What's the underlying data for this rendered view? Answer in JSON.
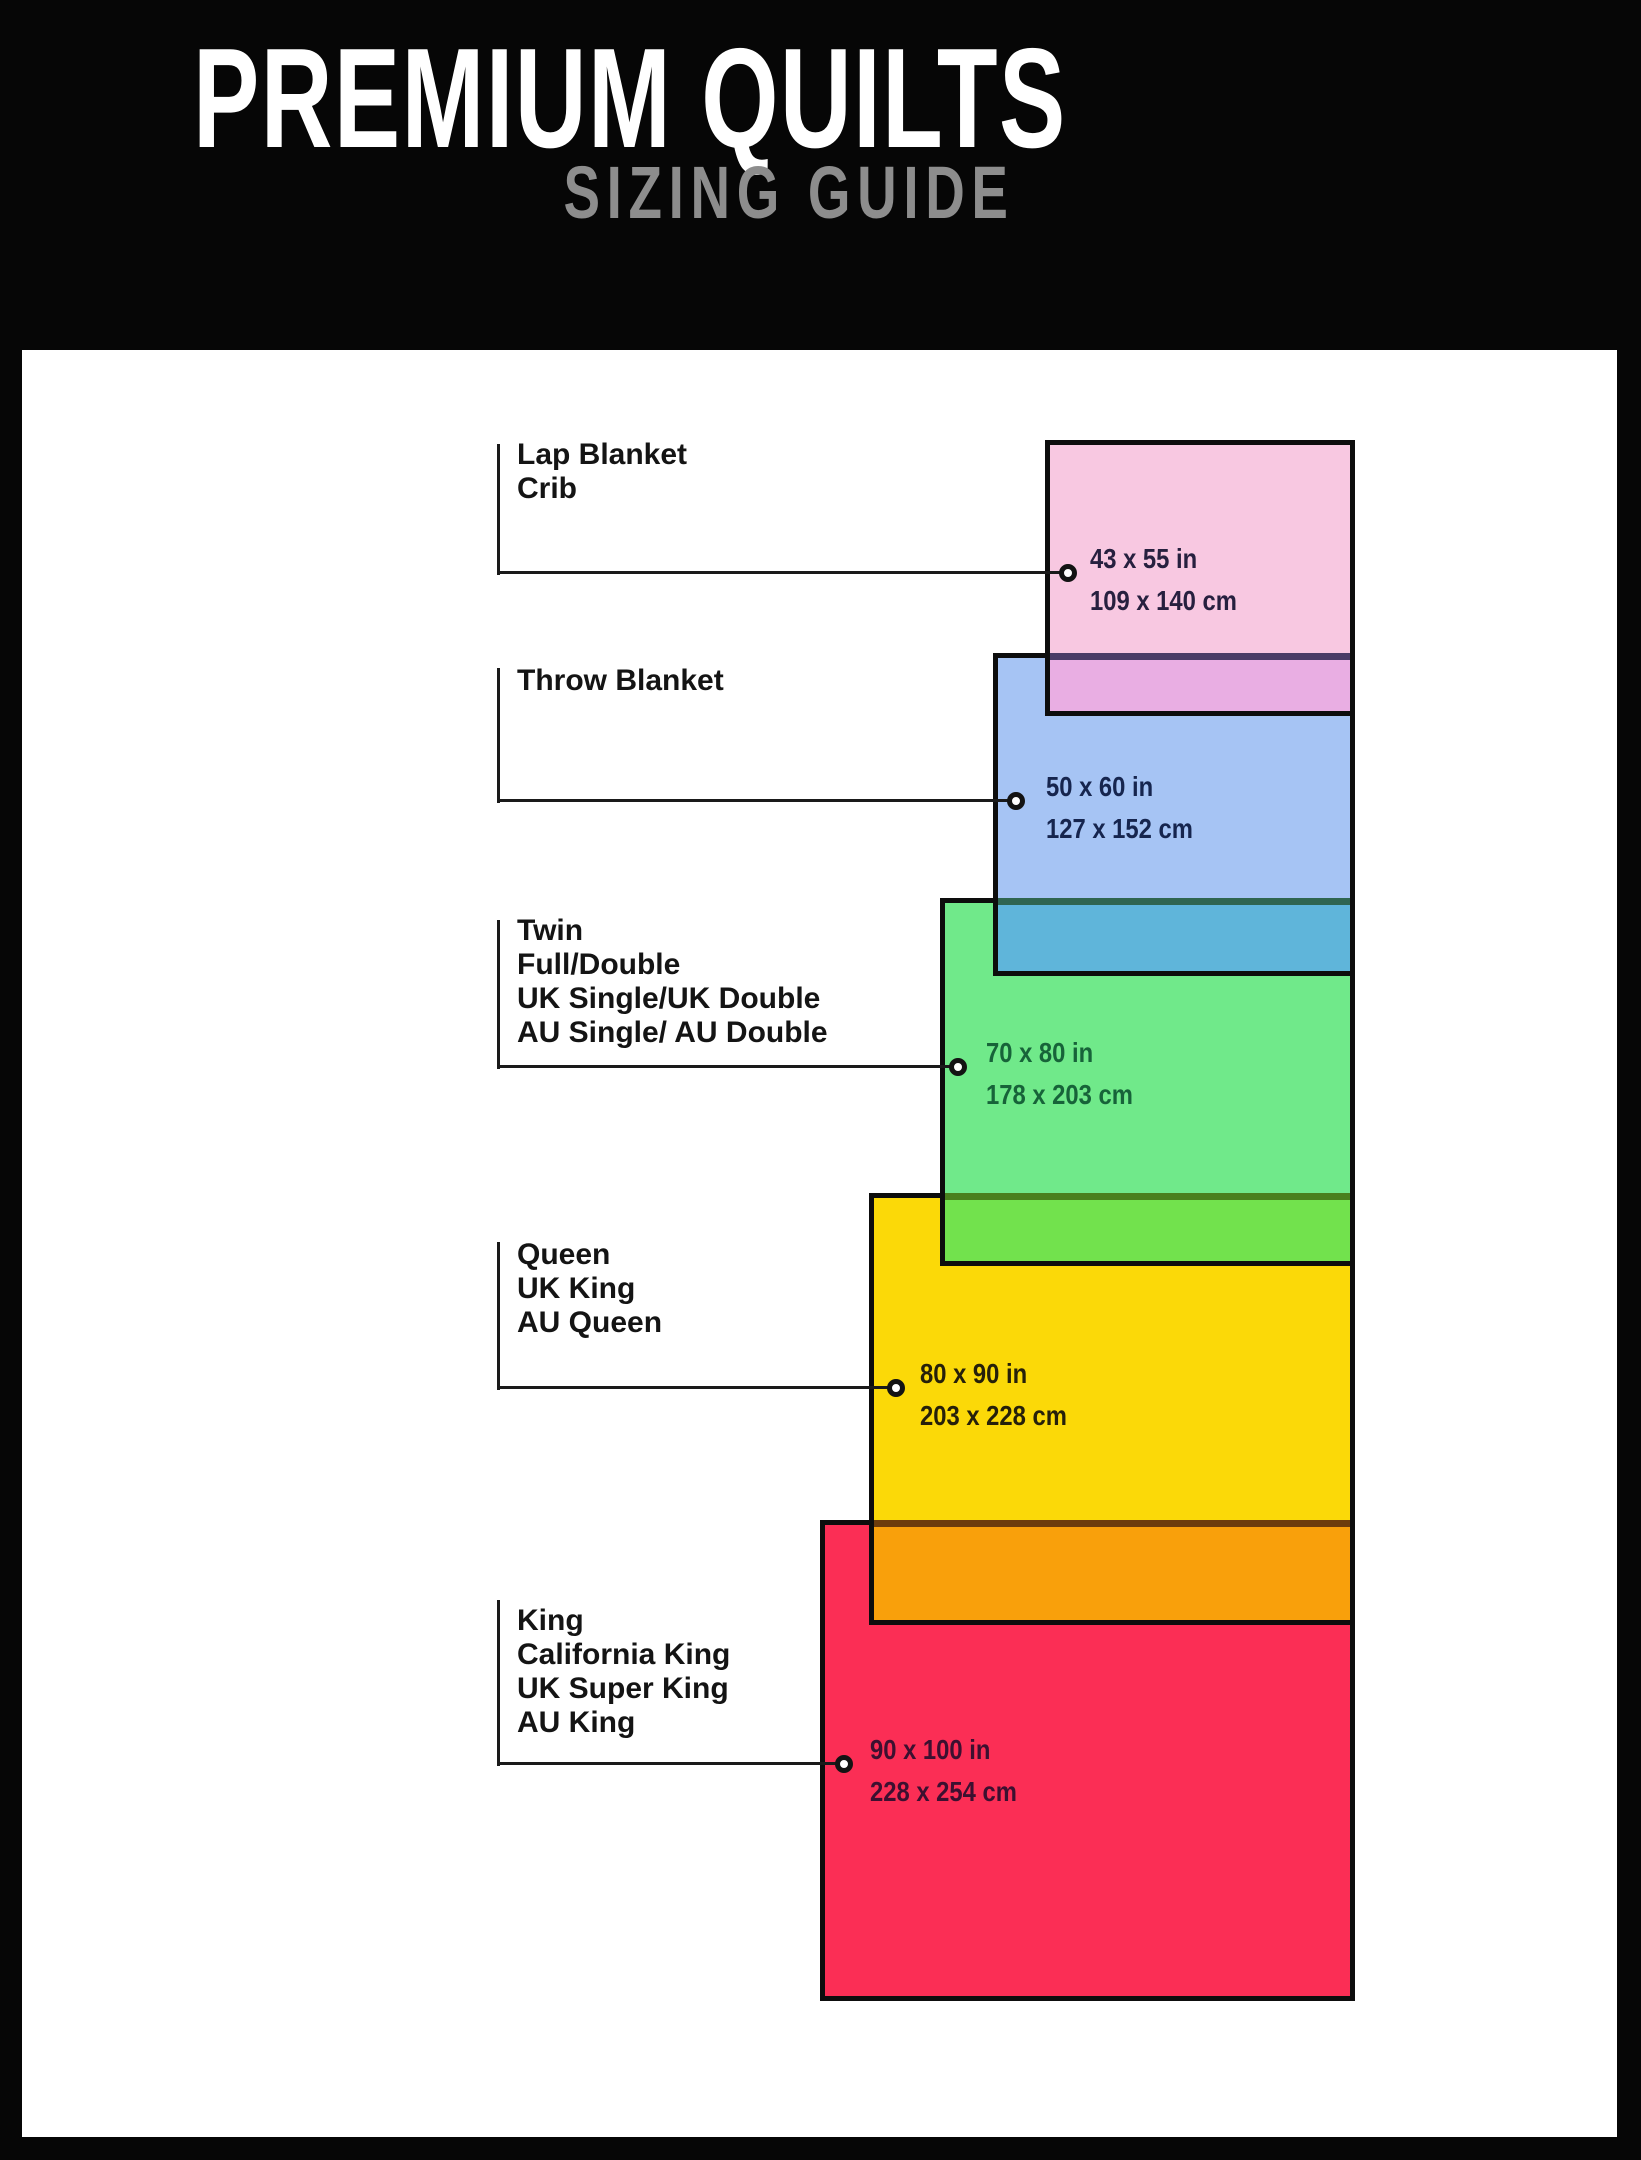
{
  "header": {
    "title": "PREMIUM QUILTS",
    "subtitle": "SIZING GUIDE",
    "title_color": "#ffffff",
    "subtitle_color": "#8d8d8d",
    "background": "#060606"
  },
  "panel": {
    "background": "#ffffff"
  },
  "leader_style": {
    "line_color": "#1a1a1a",
    "marker": "open-circle"
  },
  "sizes": [
    {
      "id": "lap-crib",
      "names": [
        "Lap Blanket",
        "Crib"
      ],
      "inches": "43 x 55 in",
      "cm": "109 x 140 cm",
      "inches_w": 43,
      "inches_h": 55,
      "cm_w": 109,
      "cm_h": 140,
      "fill": "#f8c8e1",
      "dim_text_color": "#27203f"
    },
    {
      "id": "throw",
      "names": [
        "Throw Blanket"
      ],
      "inches": "50 x 60 in",
      "cm": "127 x 152 cm",
      "inches_w": 50,
      "inches_h": 60,
      "cm_w": 127,
      "cm_h": 152,
      "fill": "#a6c4f4",
      "dim_text_color": "#16254e"
    },
    {
      "id": "twin-full",
      "names": [
        "Twin",
        "Full/Double",
        "UK Single/UK Double",
        "AU Single/ AU Double"
      ],
      "inches": "70 x 80 in",
      "cm": "178 x 203 cm",
      "inches_w": 70,
      "inches_h": 80,
      "cm_w": 178,
      "cm_h": 203,
      "fill": "#70e98a",
      "dim_text_color": "#176339"
    },
    {
      "id": "queen",
      "names": [
        "Queen",
        "UK King",
        "AU Queen"
      ],
      "inches": "80 x 90 in",
      "cm": "203 x 228 cm",
      "inches_w": 80,
      "inches_h": 90,
      "cm_w": 203,
      "cm_h": 228,
      "fill": "#fbd908",
      "dim_text_color": "#26200a"
    },
    {
      "id": "king",
      "names": [
        "King",
        "California King",
        "UK Super King",
        "AU King"
      ],
      "inches": "90 x 100 in",
      "cm": "228 x 254 cm",
      "inches_w": 90,
      "inches_h": 100,
      "cm_w": 228,
      "cm_h": 254,
      "fill": "#fb2e55",
      "dim_text_color": "#3c1030"
    }
  ],
  "overlaps": [
    {
      "pair": "lap-crib-over-throw",
      "color": "#e9aee3",
      "covered_border_tint": "#4a3c66"
    },
    {
      "pair": "throw-over-twin-full",
      "color": "#5fb5da",
      "covered_border_tint": "#2f6550"
    },
    {
      "pair": "twin-full-over-queen",
      "color": "#72e24d",
      "covered_border_tint": "#49801d"
    },
    {
      "pair": "queen-over-king",
      "color": "#f9a00b",
      "covered_border_tint": "#6e3c0c"
    }
  ]
}
